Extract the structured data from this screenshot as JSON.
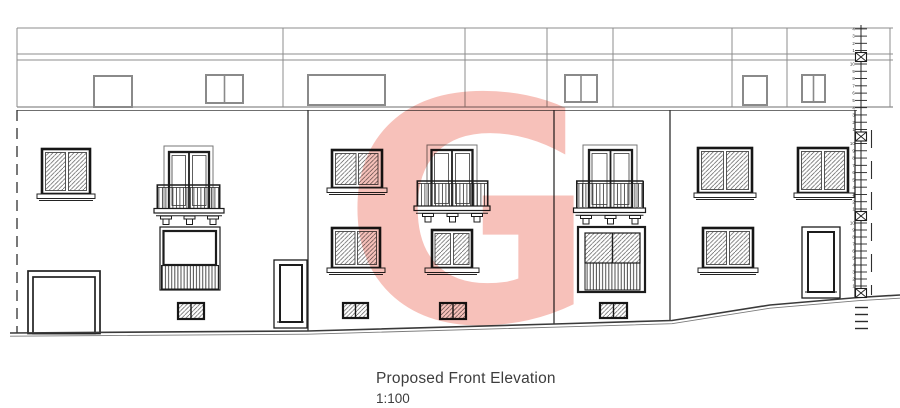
{
  "title": {
    "caption": "Proposed Front Elevation",
    "scale": "1:100"
  },
  "watermark": {
    "letter": "G",
    "color": "#f7bcb4"
  },
  "level_staff": {
    "top_labels": [
      "4",
      "3",
      "2",
      "1"
    ],
    "segment_labels": [
      "10",
      "9",
      "8",
      "7",
      "6",
      "5",
      "4",
      "3",
      "2",
      "1"
    ],
    "box_positions_y": [
      57,
      136.5,
      216,
      293
    ]
  },
  "palette": {
    "line_dark": "#1c1c1c",
    "line_medium": "#3a3a3a",
    "line_light": "#8c8c8c",
    "background": "#ffffff"
  }
}
